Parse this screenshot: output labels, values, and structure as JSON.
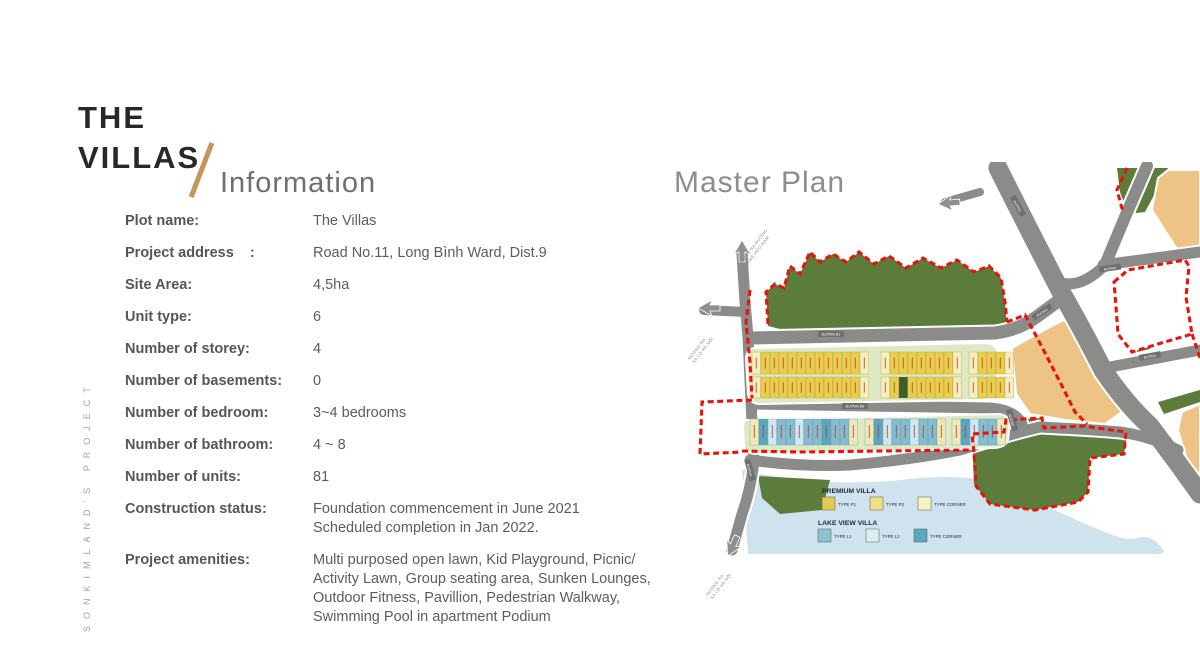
{
  "branding": {
    "title_line1": "THE",
    "title_line2": "VILLAS",
    "subtitle": "Information",
    "vertical_text": "SONKIMLAND'S PROJECT"
  },
  "info": {
    "rows": [
      {
        "label": "Plot name:",
        "value": "The Villas"
      },
      {
        "label": "Project address    :",
        "value": "Road No.11, Long Bình Ward, Dist.9"
      },
      {
        "label": "Site Area:",
        "value": "4,5ha"
      },
      {
        "label": "Unit type:",
        "value": "6"
      },
      {
        "label": "Number of storey:",
        "value": "4"
      },
      {
        "label": "Number of basements:",
        "value": "0"
      },
      {
        "label": "Number of bedroom:",
        "value": "3~4 bedrooms"
      },
      {
        "label": "Number of bathroom:",
        "value": "4 ~ 8"
      },
      {
        "label": "Number of units:",
        "value": "81"
      },
      {
        "label": "Construction status:",
        "value": "Foundation commencement in June 2021\nScheduled completion in Jan 2022."
      },
      {
        "label": "Project amenities:",
        "value": "Multi purposed open lawn, Kid Playground, Picnic/\nActivity Lawn, Group seating area, Sunken Lounges,\nOutdoor Fitness, Pavillion, Pedestrian Walkway,\nSwimming Pool in apartment Podium"
      }
    ]
  },
  "master_plan": {
    "title": "Master Plan",
    "road_labels": [
      {
        "text": "ĐƯỜNG B1"
      },
      {
        "text": "ĐƯỜNG B8"
      },
      {
        "text": "ĐƯỜNG"
      },
      {
        "text": "ĐƯỜNG"
      },
      {
        "text": "ĐƯỜNG"
      },
      {
        "text": "ĐƯỜNG"
      },
      {
        "text": "ĐƯỜNG"
      },
      {
        "text": "ĐƯỜNG"
      }
    ],
    "direction_labels": [
      {
        "line1": "HƯỚNG RA ĐƯỜNG",
        "line2": "HOÀNG HỮU NAM"
      },
      {
        "line1": "HƯỚNG RA",
        "line2": "XA LỘ HÀ NỘI"
      },
      {
        "line1": "HƯỚNG RA",
        "line2": "XA LỘ HÀ NỘI"
      }
    ],
    "legend": {
      "groups": [
        {
          "title": "PREMIUM VILLA",
          "items": [
            {
              "label": "TYPE P1",
              "color": "#e2cb50"
            },
            {
              "label": "TYPE P2",
              "color": "#ede184"
            },
            {
              "label": "TYPE CORNER",
              "color": "#f7f3c2"
            }
          ]
        },
        {
          "title": "LAKE VIEW VILLA",
          "items": [
            {
              "label": "TYPE L1",
              "color": "#8fc2d3"
            },
            {
              "label": "TYPE L2",
              "color": "#daeff3"
            },
            {
              "label": "TYPE CORNER",
              "color": "#58a8bf"
            }
          ]
        }
      ]
    },
    "colors": {
      "park": "#5c7c3c",
      "lake": "#cfe3ee",
      "orange_block": "#edc386",
      "road": "#8b8b89",
      "boundary": "#e8140c",
      "villa_strip_bg": "#dde9c5"
    }
  }
}
